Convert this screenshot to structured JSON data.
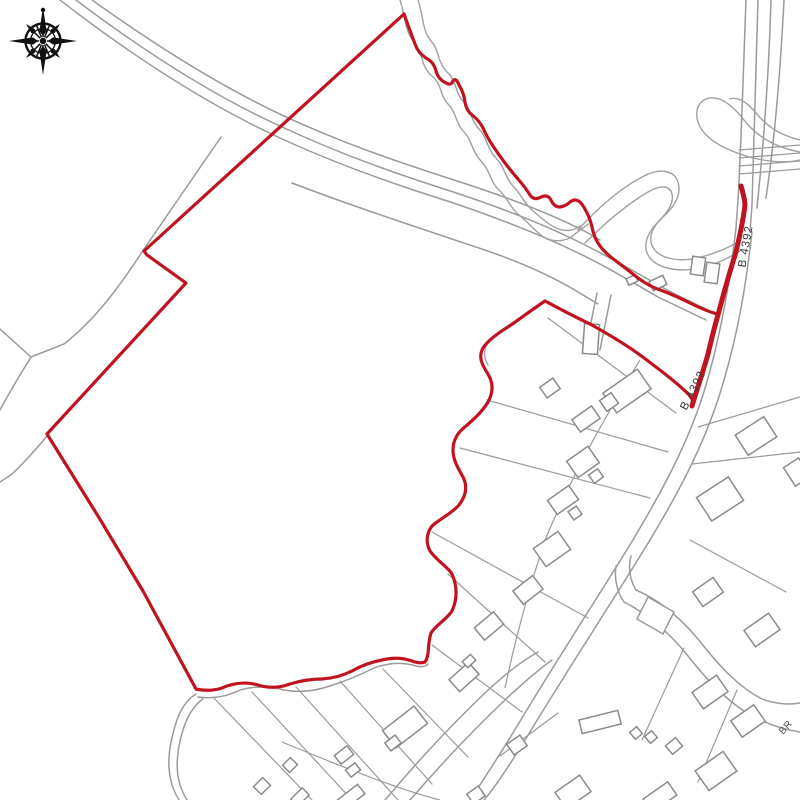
{
  "map": {
    "background_color": "#ffffff",
    "site_boundary_color": "#c0121f",
    "map_line_color": "#9a9a9a",
    "building_line_color": "#8b8b8b",
    "road_labels": [
      {
        "text": "B 4392"
      },
      {
        "text": "B 4392"
      }
    ],
    "partial_street_label": {
      "text": "BR"
    }
  }
}
